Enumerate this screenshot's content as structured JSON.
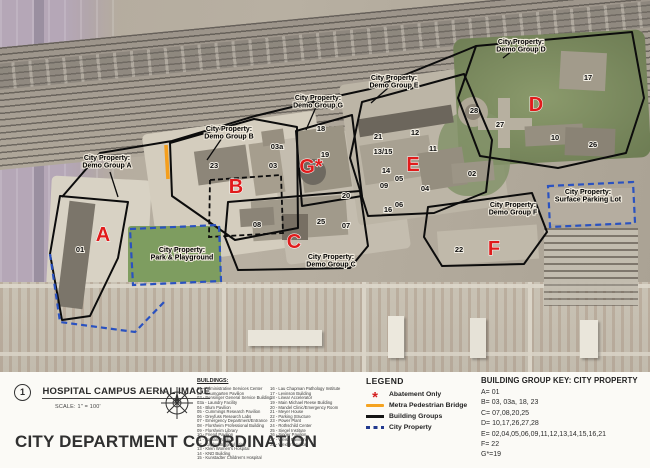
{
  "sheet": {
    "drawing_number": "1",
    "drawing_title": "HOSPITAL CAMPUS AERIAL IMAGE",
    "drawing_scale": "SCALE: 1\" = 100'",
    "sheet_title": "CITY DEPARTMENT COORDINATION",
    "north_label": "N"
  },
  "buildings": {
    "heading": "BUILDINGS:",
    "col1": [
      {
        "num": "01",
        "name": "Administrative Services Center"
      },
      {
        "num": "02",
        "name": "Baumgarten Pavilion"
      },
      {
        "num": "03",
        "name": "Bensinger General Service Building"
      },
      {
        "num": "03a",
        "name": "Laundry Facility"
      },
      {
        "num": "04",
        "name": "Blum Pavilion"
      },
      {
        "num": "05",
        "name": "Cummings Research Pavilion"
      },
      {
        "num": "06",
        "name": "Dreyfuss Research Labs"
      },
      {
        "num": "07",
        "name": "Emergency Department/Entrance"
      },
      {
        "num": "08",
        "name": "Florsheim Professional Building"
      },
      {
        "num": "09",
        "name": "Florsheim Library"
      },
      {
        "num": "10",
        "name": "Friend Pavilion"
      },
      {
        "num": "11",
        "name": "Kaplan Pavilion"
      },
      {
        "num": "12",
        "name": "Kaplan Surgical Wing"
      },
      {
        "num": "13",
        "name": "Klein Women's Hospital"
      },
      {
        "num": "14",
        "name": "KND Building"
      },
      {
        "num": "15",
        "name": "Kunstadter Children's Hospital"
      }
    ],
    "col2": [
      {
        "num": "16",
        "name": "Lau Chapman Pathology Institute"
      },
      {
        "num": "17",
        "name": "Levinson Building"
      },
      {
        "num": "18",
        "name": "Linear Accelerator"
      },
      {
        "num": "19",
        "name": "Main Michael Reese Building"
      },
      {
        "num": "20",
        "name": "Mandel Clinic/Emergency Room"
      },
      {
        "num": "21",
        "name": "Meyer House"
      },
      {
        "num": "22",
        "name": "Parking Structure"
      },
      {
        "num": "23",
        "name": "Power Plant"
      },
      {
        "num": "24",
        "name": "Rothschild Center"
      },
      {
        "num": "25",
        "name": "Siegel Institute"
      },
      {
        "num": "26",
        "name": "Singer Pavilion"
      },
      {
        "num": "27",
        "name": "Weiss Pavilion"
      },
      {
        "num": "28",
        "name": "Wexler Pavilion"
      }
    ]
  },
  "legend": {
    "heading": "LEGEND",
    "items": [
      {
        "symbol": "abatement-asterisk",
        "label": "Abatement Only",
        "color": "#d42020"
      },
      {
        "symbol": "metra-bridge-line",
        "label": "Metra Pedestrian Bridge",
        "color": "#f5a321"
      },
      {
        "symbol": "building-groups-line",
        "label": "Building Groups",
        "color": "#141414"
      },
      {
        "symbol": "city-property-dash",
        "label": "City Property",
        "color": "#22398f"
      }
    ]
  },
  "group_key": {
    "heading": "BUILDING GROUP KEY: CITY PROPERTY",
    "entries": [
      "A= 01",
      "B= 03, 03a, 18, 23",
      "C= 07,08,20,25",
      "D= 10,17,26,27,28",
      "E= 02,04,05,06,09,11,12,13,14,15,16,21",
      "F= 22",
      "G*=19"
    ]
  },
  "map": {
    "colors": {
      "group_letter": "#e01b1b",
      "boundary": "#0c0c0c",
      "city_property": "#2a52c0",
      "bridge": "#f59f1d"
    },
    "area_labels": [
      {
        "x": 107,
        "y": 160,
        "lines": [
          "City Property:",
          "Demo Group A"
        ]
      },
      {
        "x": 229,
        "y": 131,
        "lines": [
          "City Property:",
          "Demo Group B"
        ]
      },
      {
        "x": 318,
        "y": 100,
        "lines": [
          "City Property:",
          "Demo Group G"
        ]
      },
      {
        "x": 394,
        "y": 80,
        "lines": [
          "City Property:",
          "Demo Group E"
        ]
      },
      {
        "x": 521,
        "y": 44,
        "lines": [
          "City Property:",
          "Demo Group D"
        ]
      },
      {
        "x": 331,
        "y": 259,
        "lines": [
          "City Property:",
          "Demo Group C"
        ]
      },
      {
        "x": 513,
        "y": 207,
        "lines": [
          "City Property:",
          "Demo Group F"
        ]
      },
      {
        "x": 588,
        "y": 194,
        "lines": [
          "City Property:",
          "Surface Parking Lot"
        ]
      },
      {
        "x": 182,
        "y": 252,
        "lines": [
          "City Property:",
          "Park & Playground"
        ]
      }
    ],
    "group_letters": [
      {
        "x": 103,
        "y": 241,
        "label": "A"
      },
      {
        "x": 236,
        "y": 193,
        "label": "B"
      },
      {
        "x": 311,
        "y": 173,
        "label": "G*"
      },
      {
        "x": 294,
        "y": 248,
        "label": "C"
      },
      {
        "x": 413,
        "y": 171,
        "label": "E"
      },
      {
        "x": 536,
        "y": 111,
        "label": "D"
      },
      {
        "x": 494,
        "y": 255,
        "label": "F"
      }
    ],
    "building_markers": [
      {
        "x": 80,
        "y": 252,
        "label": "01"
      },
      {
        "x": 214,
        "y": 168,
        "label": "23"
      },
      {
        "x": 277,
        "y": 149,
        "label": "03a"
      },
      {
        "x": 273,
        "y": 168,
        "label": "03"
      },
      {
        "x": 321,
        "y": 131,
        "label": "18"
      },
      {
        "x": 325,
        "y": 157,
        "label": "19"
      },
      {
        "x": 346,
        "y": 198,
        "label": "20"
      },
      {
        "x": 321,
        "y": 224,
        "label": "25"
      },
      {
        "x": 257,
        "y": 227,
        "label": "08"
      },
      {
        "x": 346,
        "y": 228,
        "label": "07"
      },
      {
        "x": 378,
        "y": 139,
        "label": "21"
      },
      {
        "x": 415,
        "y": 135,
        "label": "12"
      },
      {
        "x": 383,
        "y": 154,
        "label": "13/15"
      },
      {
        "x": 433,
        "y": 151,
        "label": "11"
      },
      {
        "x": 386,
        "y": 173,
        "label": "14"
      },
      {
        "x": 399,
        "y": 181,
        "label": "05"
      },
      {
        "x": 384,
        "y": 188,
        "label": "09"
      },
      {
        "x": 425,
        "y": 191,
        "label": "04"
      },
      {
        "x": 399,
        "y": 207,
        "label": "06"
      },
      {
        "x": 388,
        "y": 212,
        "label": "16"
      },
      {
        "x": 472,
        "y": 176,
        "label": "02"
      },
      {
        "x": 474,
        "y": 113,
        "label": "28"
      },
      {
        "x": 500,
        "y": 127,
        "label": "27"
      },
      {
        "x": 588,
        "y": 80,
        "label": "17"
      },
      {
        "x": 555,
        "y": 140,
        "label": "10"
      },
      {
        "x": 593,
        "y": 147,
        "label": "26"
      },
      {
        "x": 459,
        "y": 252,
        "label": "22"
      }
    ]
  }
}
